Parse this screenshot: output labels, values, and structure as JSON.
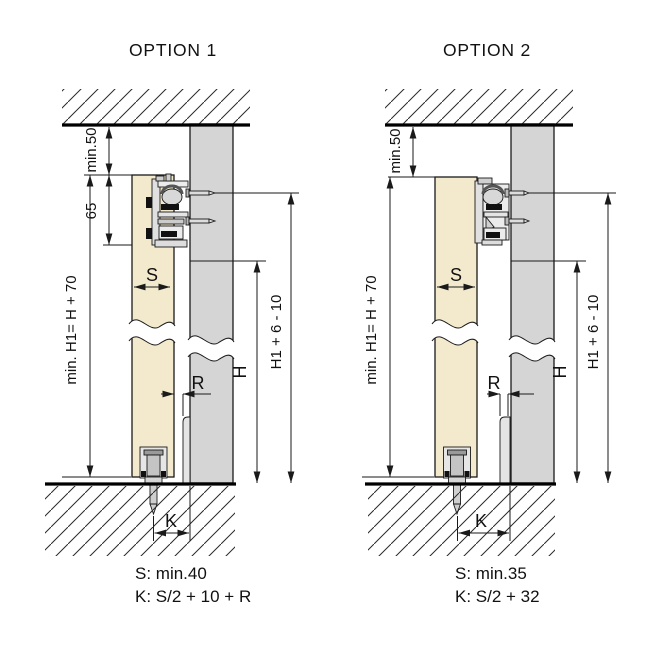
{
  "diagram": {
    "option1": {
      "title": "OPTION 1",
      "dims": {
        "ceiling_clearance": "min.50",
        "track_zone": "65",
        "door_height": "min. H1= H + 70",
        "door_thickness": "S",
        "wall_height": "H",
        "overall_height": "H1 + 6 - 10",
        "reveal": "R",
        "guide_offset": "K"
      },
      "formulas": {
        "s": "S: min.40",
        "k": "K: S/2 + 10 + R"
      }
    },
    "option2": {
      "title": "OPTION 2",
      "dims": {
        "ceiling_clearance": "min.50",
        "door_height": "min. H1= H + 70",
        "door_thickness": "S",
        "wall_height": "H",
        "overall_height": "H1 + 6 - 10",
        "reveal": "R",
        "guide_offset": "K"
      },
      "formulas": {
        "s": "S: min.35",
        "k": "K: S/2 + 32"
      }
    }
  },
  "colors": {
    "door": "#f3e9cd",
    "wall": "#d5d5d5",
    "skirting": "#e4e4e4",
    "hardware": "#ececec",
    "line": "#1a1a1a"
  }
}
